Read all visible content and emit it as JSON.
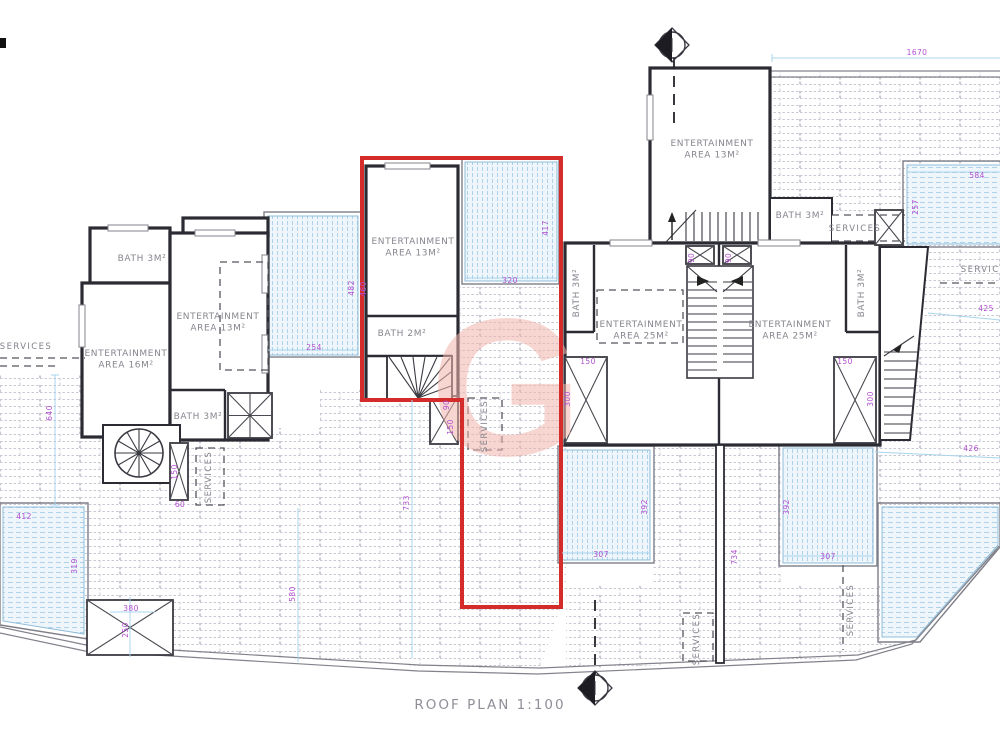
{
  "plan": {
    "title": "ROOF PLAN 1:100",
    "watermark_letter": "G",
    "colors": {
      "wall": "#2b2b33",
      "highlight_red": "#d42b2b",
      "dimension_purple": "#b24fd0",
      "pool_blue": "#aed2e9",
      "brick_gray": "#c9c9d3",
      "label_gray": "#86868f",
      "watermark_pink": "#f2b5ad"
    },
    "room_labels": [
      {
        "lines": [
          "ENTERTAINMENT",
          "AREA 16M²"
        ],
        "x": 126,
        "y": 356
      },
      {
        "lines": [
          "ENTERTAINMENT",
          "AREA 13M²"
        ],
        "x": 218,
        "y": 319
      },
      {
        "text": "BATH 3M²",
        "x": 142,
        "y": 261
      },
      {
        "text": "BATH 3M²",
        "x": 198,
        "y": 419
      },
      {
        "lines": [
          "ENTERTAINMENT",
          "AREA 13M²"
        ],
        "x": 413,
        "y": 244
      },
      {
        "text": "BATH 2M²",
        "x": 402,
        "y": 336
      },
      {
        "lines": [
          "ENTERTAINMENT",
          "AREA 13M²"
        ],
        "x": 712,
        "y": 146
      },
      {
        "text": "BATH 3M²",
        "x": 800,
        "y": 218
      },
      {
        "lines": [
          "ENTERTAINMENT",
          "AREA 25M²"
        ],
        "x": 641,
        "y": 327
      },
      {
        "lines": [
          "ENTERTAINMENT",
          "AREA 25M²"
        ],
        "x": 790,
        "y": 327
      },
      {
        "text": "BATH 3M²",
        "x": 579,
        "y": 293,
        "rot": -90
      },
      {
        "text": "BATH 3M²",
        "x": 864,
        "y": 293,
        "rot": -90
      }
    ],
    "service_labels": [
      {
        "text": "SERVICES",
        "x": 26,
        "y": 349
      },
      {
        "text": "SERVICES",
        "x": 211,
        "y": 477,
        "rot": -90
      },
      {
        "text": "SERVICES",
        "x": 487,
        "y": 426,
        "rot": -90
      },
      {
        "text": "SERVICES",
        "x": 855,
        "y": 231
      },
      {
        "text": "SERVICES",
        "x": 987,
        "y": 272
      },
      {
        "text": "SERVICES",
        "x": 699,
        "y": 639,
        "rot": -90
      },
      {
        "text": "SERVICES",
        "x": 853,
        "y": 610,
        "rot": -90
      }
    ],
    "dimensions": [
      {
        "text": "1670",
        "x": 917,
        "y": 55
      },
      {
        "text": "412",
        "x": 24,
        "y": 519
      },
      {
        "text": "319",
        "x": 77,
        "y": 566,
        "rot": -90
      },
      {
        "text": "640",
        "x": 52,
        "y": 413,
        "rot": -90
      },
      {
        "text": "380",
        "x": 131,
        "y": 611
      },
      {
        "text": "250",
        "x": 128,
        "y": 630,
        "rot": -90
      },
      {
        "text": "580",
        "x": 295,
        "y": 594,
        "rot": -90
      },
      {
        "text": "733",
        "x": 409,
        "y": 503,
        "rot": -90
      },
      {
        "text": "254",
        "x": 314,
        "y": 350
      },
      {
        "text": "482",
        "x": 354,
        "y": 288,
        "rot": -90
      },
      {
        "text": "460",
        "x": 366,
        "y": 289,
        "rot": -90
      },
      {
        "text": "320",
        "x": 510,
        "y": 283
      },
      {
        "text": "417",
        "x": 548,
        "y": 228,
        "rot": -90
      },
      {
        "text": "90",
        "x": 449,
        "y": 405,
        "rot": -90
      },
      {
        "text": "150",
        "x": 453,
        "y": 427,
        "rot": -90
      },
      {
        "text": "150",
        "x": 177,
        "y": 472,
        "rot": -90
      },
      {
        "text": "60",
        "x": 180,
        "y": 507
      },
      {
        "text": "150",
        "x": 588,
        "y": 364
      },
      {
        "text": "300",
        "x": 570,
        "y": 399,
        "rot": -90
      },
      {
        "text": "150",
        "x": 845,
        "y": 364
      },
      {
        "text": "300",
        "x": 873,
        "y": 399,
        "rot": -90
      },
      {
        "text": "90",
        "x": 694,
        "y": 258,
        "rot": -90
      },
      {
        "text": "90",
        "x": 731,
        "y": 258,
        "rot": -90
      },
      {
        "text": "307",
        "x": 601,
        "y": 557
      },
      {
        "text": "392",
        "x": 647,
        "y": 507,
        "rot": -90
      },
      {
        "text": "307",
        "x": 828,
        "y": 559
      },
      {
        "text": "392",
        "x": 789,
        "y": 507,
        "rot": -90
      },
      {
        "text": "734",
        "x": 737,
        "y": 557,
        "rot": -90
      },
      {
        "text": "584",
        "x": 977,
        "y": 178
      },
      {
        "text": "257",
        "x": 918,
        "y": 207,
        "rot": -90
      },
      {
        "text": "426",
        "x": 971,
        "y": 451
      },
      {
        "text": "425",
        "x": 986,
        "y": 311
      }
    ]
  }
}
